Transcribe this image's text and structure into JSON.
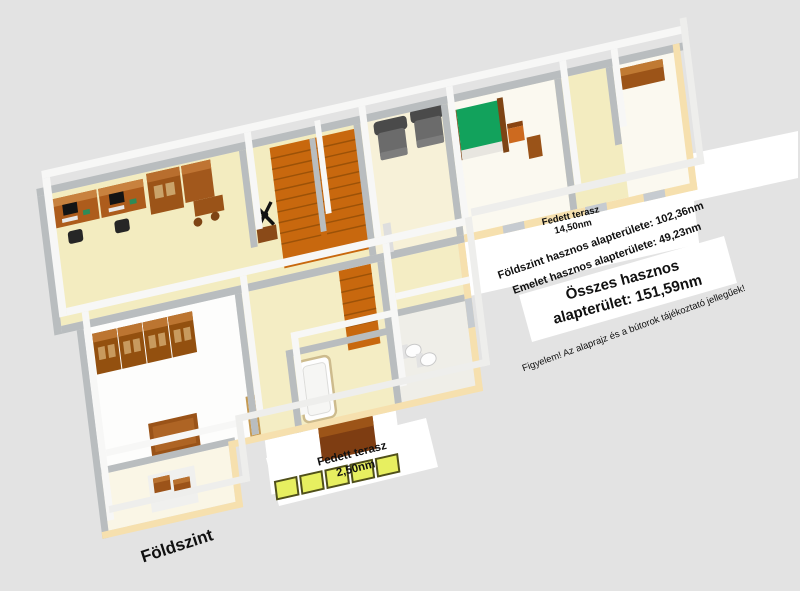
{
  "labels": {
    "upper_terrace": {
      "line1": "Fedett terasz",
      "line2": "14,50nm"
    },
    "area_ground": "Földszint hasznos alapterülete: 102,36nm",
    "area_upper": "Emelet hasznos alapterülete: 49,23nm",
    "total": {
      "line1": "Összes hasznos",
      "line2": "alapterület: 151,59nm"
    },
    "disclaimer": "Figyelem! Az alaprajz és a bútorok tájékoztató jellegűek!",
    "lower_terrace": {
      "line1": "Fedett terasz",
      "line2": "2,50nm"
    },
    "floor_name": "Földszint"
  },
  "palette": {
    "background": "#e3e3e3",
    "label_band": "#ffffff",
    "text": "#101010",
    "wall_top_white": "#f7f7f6",
    "wall_side_gray": "#b9bdbf",
    "exterior_wall_cream": "#f6e0ae",
    "exterior_wall_top": "#eeeeec",
    "floor_cream": "#f3ecc0",
    "floor_white": "#fdfdfc",
    "stairs_orange": "#c8680e",
    "furniture_brown": "#9a5318",
    "furniture_brown_light": "#c07a33",
    "bed_green": "#12a25c",
    "armchair_gray": "#6b6b6b",
    "planter_yellow": "#e7ef60",
    "fixture_white": "#fdfdfd"
  }
}
